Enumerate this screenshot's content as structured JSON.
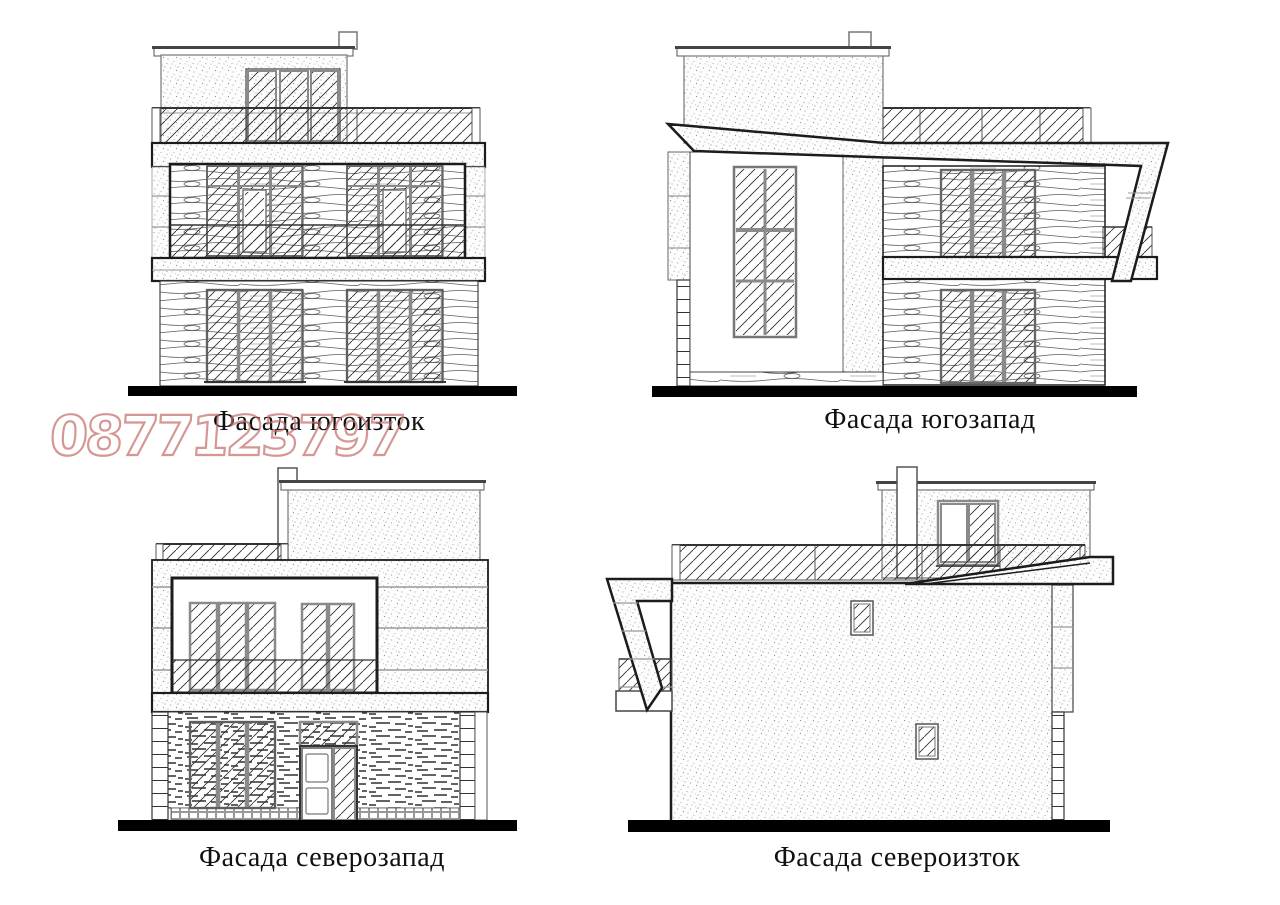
{
  "document": {
    "type": "architectural facade elevations sheet",
    "background_color": "#ffffff",
    "line_color": "#1c1c1c",
    "frame_color": "#8a8a8a",
    "ground_line_color": "#000000"
  },
  "watermark": {
    "text": "0877123797",
    "color": "#c4706c"
  },
  "facades": [
    {
      "id": "southeast",
      "label": "Фасада югоизток"
    },
    {
      "id": "southwest",
      "label": "Фасада югозапад"
    },
    {
      "id": "northwest",
      "label": "Фасада северозапад"
    },
    {
      "id": "northeast",
      "label": "Фасада североизток"
    }
  ]
}
